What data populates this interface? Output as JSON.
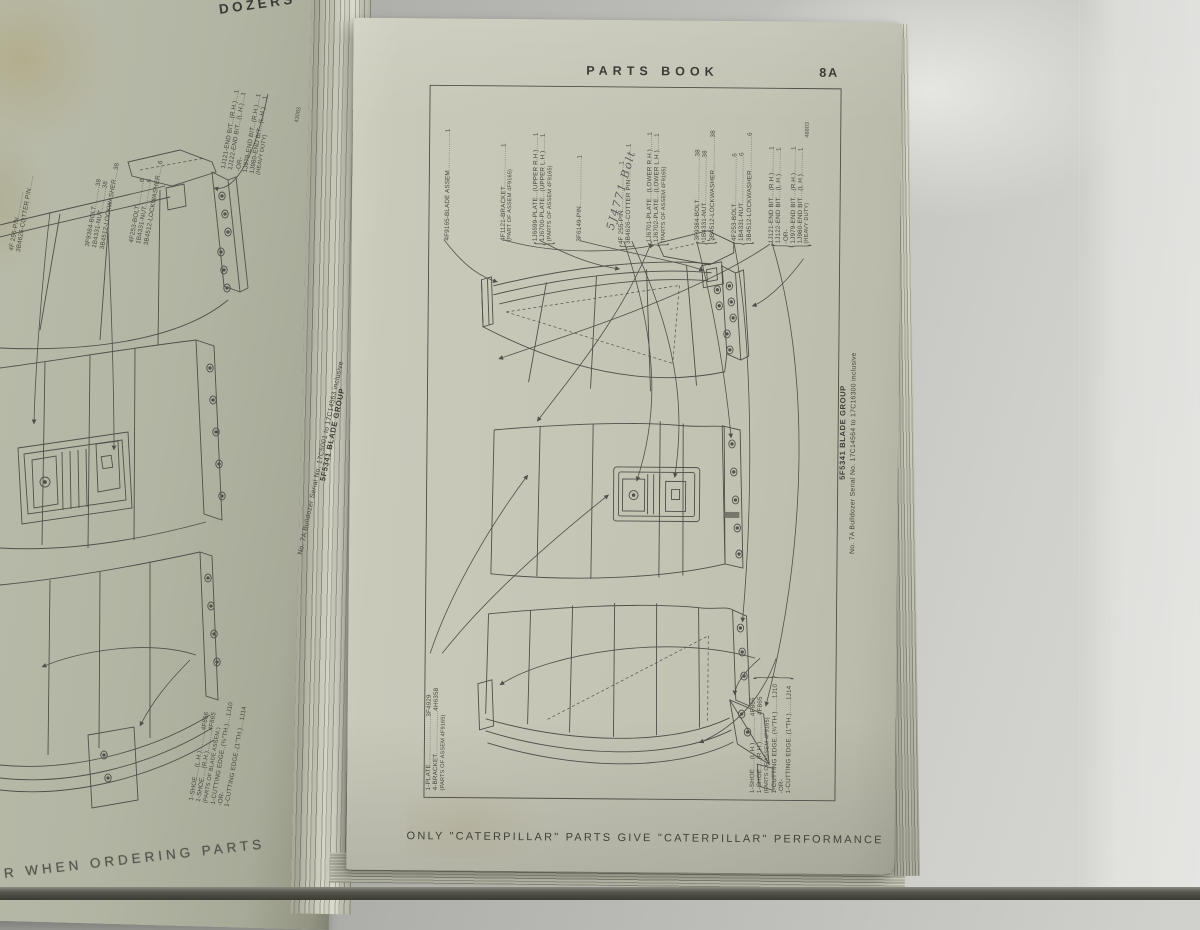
{
  "colors": {
    "background": "#b6b6b2",
    "paper_right": "#c6c6b7",
    "paper_left": "#b2b4a3",
    "ink": "#45453f",
    "handwriting_ink": "#4b4b54",
    "table_edge": "#3b3b33"
  },
  "glyphs": {
    "brace_open": "{",
    "brace_close": "}"
  },
  "right_page": {
    "header": "PARTS  BOOK",
    "page_number": "8A",
    "caption": "ONLY  \"CATERPILLAR\"  PARTS  GIVE  \"CATERPILLAR\"  PERFORMANCE",
    "drawing_number": "48803",
    "handwriting": "5J4771 Bolt",
    "side_title": {
      "group": "5F5341  BLADE GROUP",
      "serial": "No. 7A Bulldozer Serial No. 17C14564 to 17C16300 inclusive"
    },
    "top_labels": [
      {
        "lines": [
          "4F9165-BLADE ASSEM....................1"
        ]
      },
      {
        "lines": [
          "4F1121-BRACKET.....................1",
          "(PART OF ASSEM 4F9165)"
        ]
      },
      {
        "lines": [
          "1J6699-PLATE...(UPPER R.H.).......1",
          "1J6700-PLATE...(UPPER L.H.).......1",
          "(PARTS OF ASSEM 4F9165)"
        ]
      },
      {
        "lines": [
          "3F6149-PIN.........................1"
        ]
      },
      {
        "lines": [
          "4F 255-PIN........................1",
          "3B4626-COTTER PIN.................1"
        ]
      },
      {
        "lines": [
          "1J6701-PLATE...(LOWER R.H.).......1",
          "1J6702-PLATE...(LOWER L.H.).......1",
          "(PARTS OF ASSEM 4F9165)"
        ]
      },
      {
        "lines": [
          "3F9384-BOLT.......................38",
          "1B4331-NUT........................38",
          "3B4512-LOCKWASHER.................38"
        ]
      },
      {
        "lines": [
          "4F253-BOLT.........................6",
          "1B4331-NUT.........................6",
          "3B4512-LOCKWASHER..................6"
        ]
      },
      {
        "lines": [
          "1J121-END BIT....(R.H.)............1",
          "1J122-END BIT....(L.H.)............1",
          "-OR-",
          "1J979-END BIT....(R.H.)............1",
          "1J980-END BIT....(L.H.)............1",
          "(HEAVY DUTY)"
        ]
      }
    ],
    "left_labels": {
      "lines": [
        "1-PLATE.........................3F4929",
        "4-BRACKET.......................4H6358",
        "(PARTS OF ASSEM 4F9165)"
      ]
    },
    "bottom_right_labels": {
      "lines": [
        "1-SHOE.....(L.H.)..............4F866",
        "1-SHOE.....(R.H.)..............4F865",
        "(PARTS OF ASSEM 4F9165)",
        "1-CUTTING EDGE..(¾″TH.).......1J10",
        "-OR-",
        "1-CUTTING EDGE..(1″TH.).......1J14"
      ]
    }
  },
  "left_page": {
    "header": "DOZERS",
    "footer": "R  WHEN  ORDERING  PARTS",
    "drawing_number": "43083",
    "side_title": {
      "group": "5F5341  BLADE GROUP",
      "serial": "No. 7A Bulldozer Serial No. 17C5001 to 17C14563 inclusive"
    },
    "top_labels": [
      {
        "lines": [
          "4F 255-PIN..............",
          "3B4626-COTTER PIN......."
        ]
      },
      {
        "lines": [
          "3F9384-BOLT...........38",
          "1B4331-NUT............38",
          "3B4512-LOCKWASHER.....38"
        ]
      },
      {
        "lines": [
          "4F253-BOLT.............6",
          "1B4331-NUT.............6",
          "3B4512-LOCKWASHER......6"
        ]
      },
      {
        "lines": [
          "1J121-END BIT...(R.H.)....1",
          "1J122-END BIT...(L.H.)....1",
          "-OR-",
          "1J979-END BIT...(R.H.)....1",
          "1J980-END BIT...(L.H.)....1",
          "(HEAVY DUTY)"
        ]
      }
    ],
    "bottom_labels": {
      "lines": [
        "1-SHOE.....(L.H.)...........4F866",
        "1-SHOE.....(R.H.)...........4F865",
        "(PARTS OF BLADE ASSEM.)",
        "1-CUTTING EDGE..(¾″TH.)....1J10",
        "-OR-",
        "1-CUTTING EDGE..(1″TH.)....1J14"
      ]
    }
  }
}
